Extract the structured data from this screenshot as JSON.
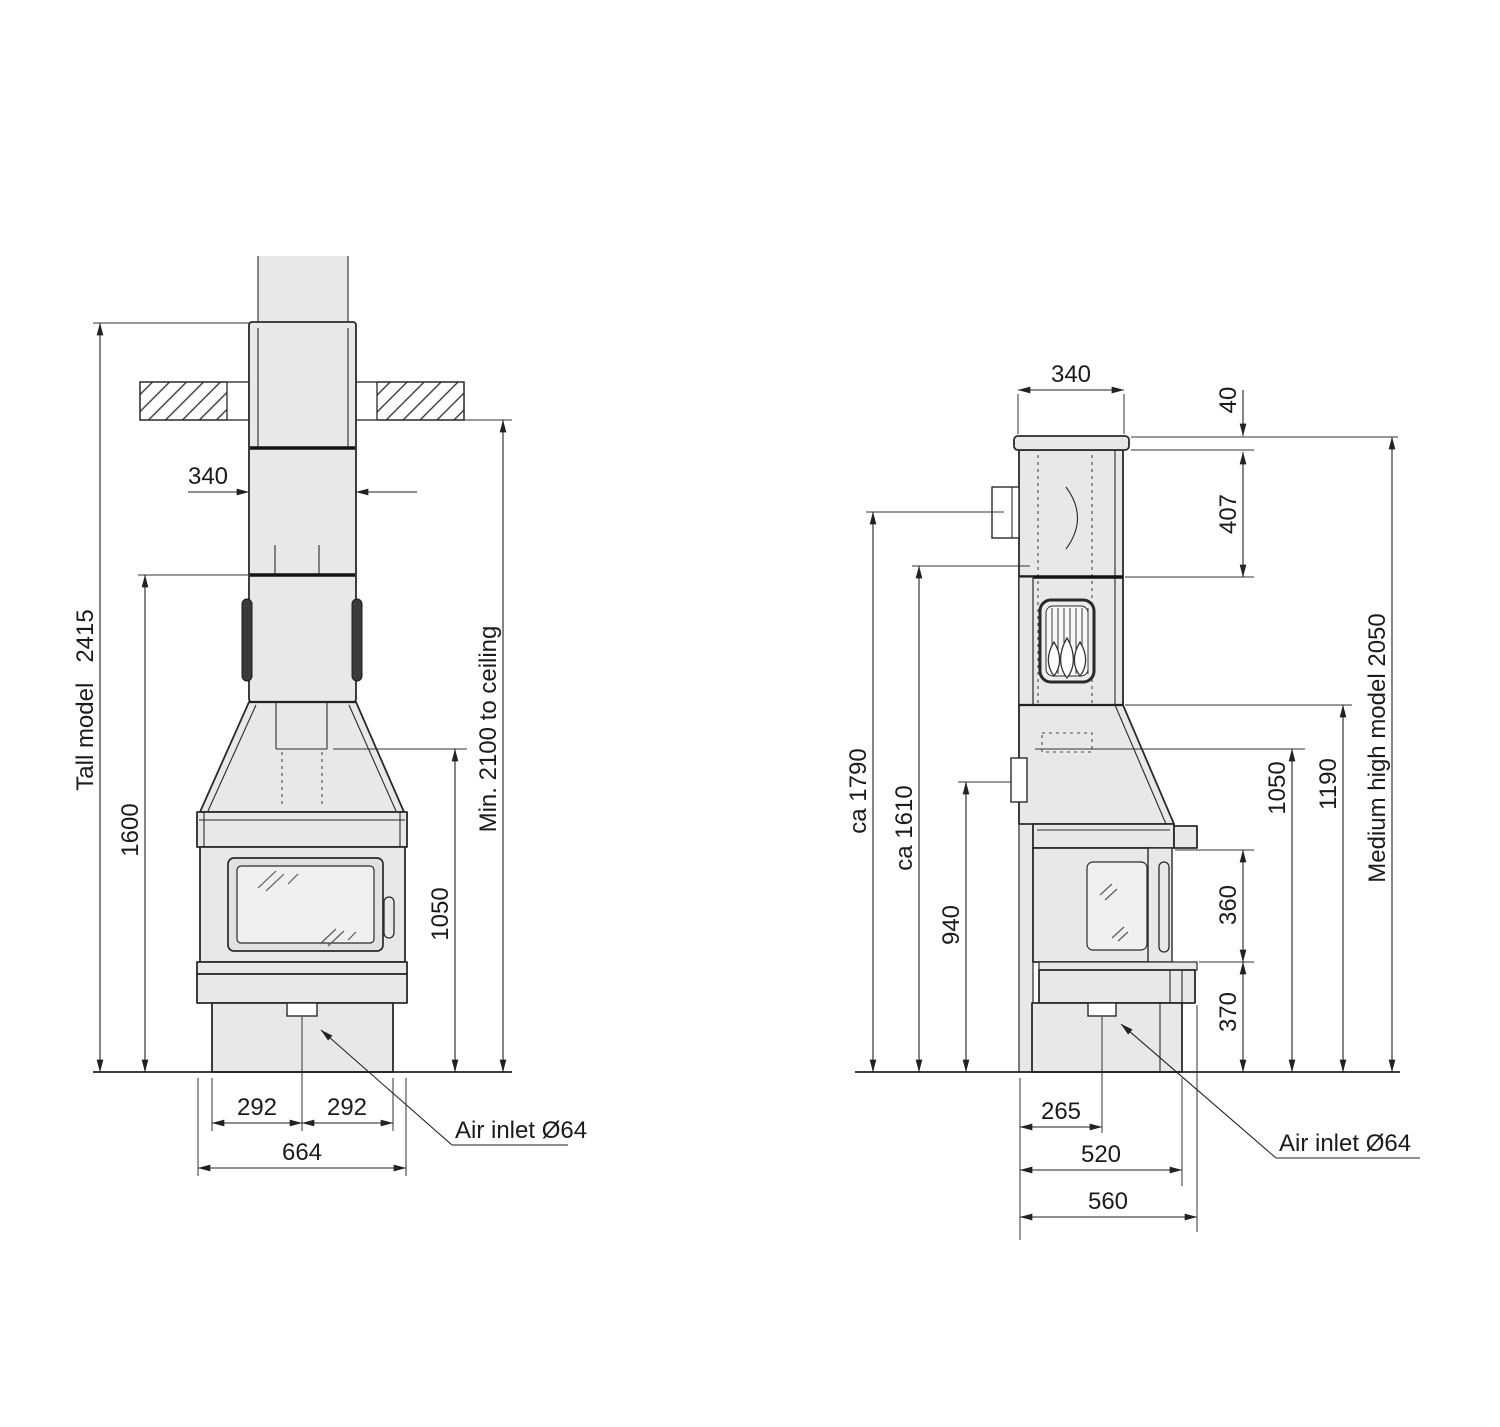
{
  "figure": {
    "background": "#ffffff",
    "ink": "#222222",
    "body_fill": "#e8e8e8",
    "glass_fill": "#f0f0f0",
    "dark_fill": "#3a3a3a"
  },
  "front_view": {
    "labels": {
      "model_height": "Tall model   2415",
      "flue_width": "340",
      "mid_height": "1600",
      "ceiling_clearance": "Min. 2100 to ceiling",
      "opening_height": "1050",
      "base_left_half": "292",
      "base_right_half": "292",
      "total_width": "664",
      "air_inlet": "Air inlet Ø64"
    }
  },
  "side_view": {
    "labels": {
      "flue_depth": "340",
      "top_plate": "40",
      "upper_section": "407",
      "rear_outlet_height": "ca 1790",
      "rear_flue_height": "ca 1610",
      "vent_height": "940",
      "door_opening": "360",
      "plinth": "370",
      "hood_underside": "1050",
      "shoulder_height": "1190",
      "model_height": "Medium high model 2050",
      "air_inlet_offset": "265",
      "body_depth": "520",
      "total_depth": "560",
      "air_inlet": "Air inlet Ø64"
    }
  }
}
